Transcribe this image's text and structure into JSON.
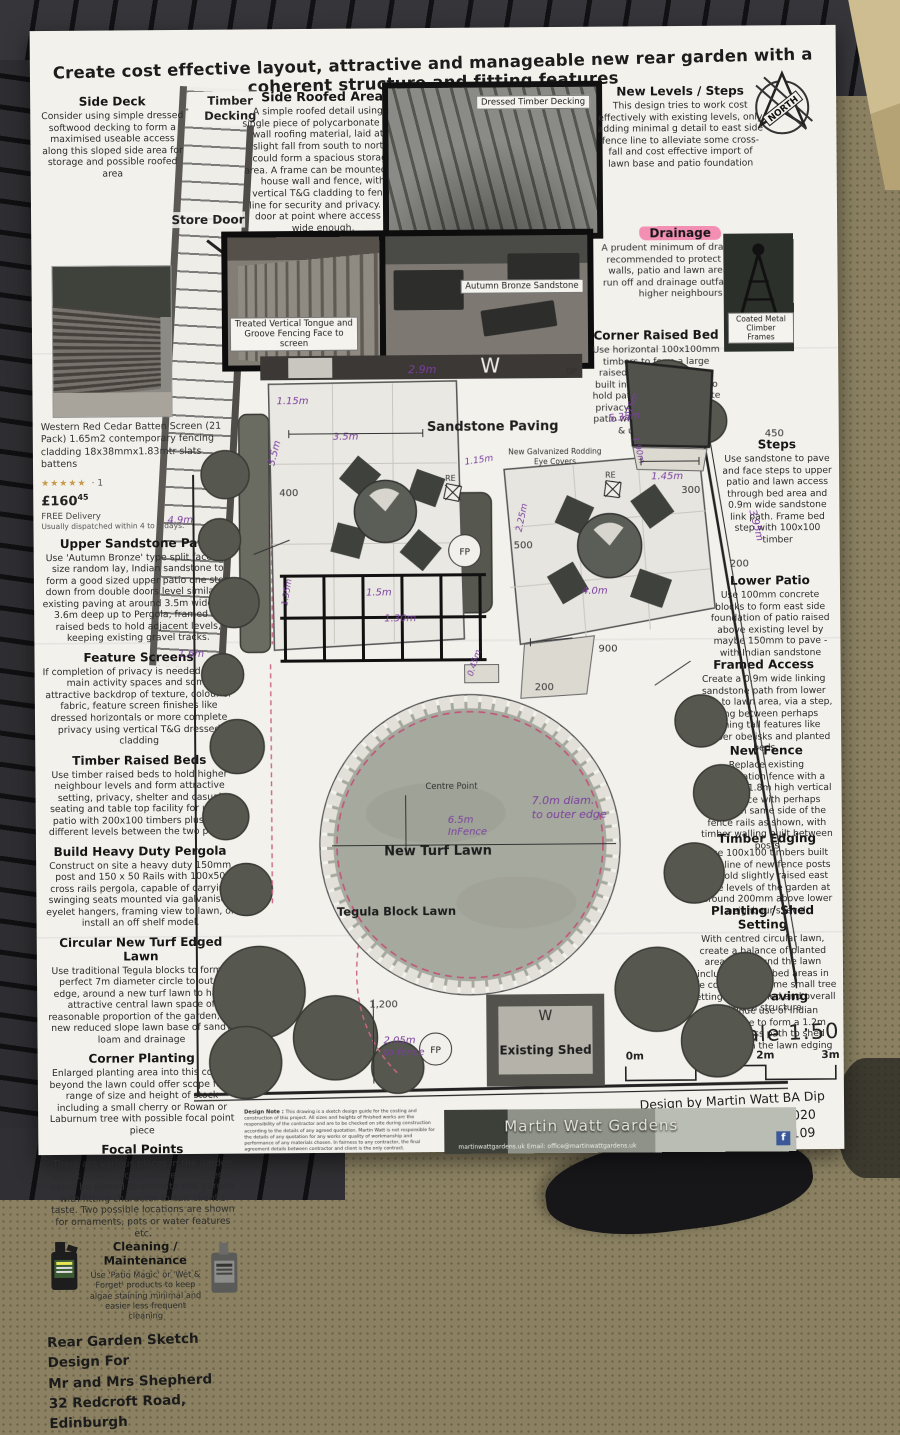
{
  "title": "Create cost effective layout, attractive and manageable new rear garden with a coherent structure and fitting features",
  "north_label": "NORTH",
  "left_column": {
    "side_deck_heading": "Side Deck",
    "side_deck_body": "Consider using simple dressed softwood decking to form a maximised useable access along this sloped side area for storage and possible roofed area",
    "timber_decking_label": "Timber Decking",
    "store_door_label": "Store Door",
    "product": {
      "caption": "Western Red Cedar Batten Screen (21 Pack) 1.65m2 contemporary fencing cladding 18x38mmx1.83mtr slats battens",
      "stars": "★★★★★",
      "rating": "· 1",
      "price_main": "£160",
      "price_sup": "45",
      "delivery": "FREE Delivery",
      "dispatch": "Usually dispatched within 4 to 5 days."
    },
    "sections": [
      {
        "heading": "Upper Sandstone Patio",
        "body": "Use 'Autumn Bronze' type split faced, 3 size random lay, Indian sandstone to form a good sized upper patio one step down from double doors level similar to existing paving at around 3.5m wide and 3.6m deep up to Pergola, framed by raised beds to hold adjacent levels, keeping existing gravel tracks."
      },
      {
        "heading": "Feature Screens",
        "body": "If completion of privacy is needed for the main activity spaces and some attractive backdrop of texture, colour or fabric, feature screen finishes like dressed horizontals or more complete privacy using vertical T&G dressed cladding"
      },
      {
        "heading": "Timber Raised Beds",
        "body": "Use timber raised beds to hold higher neighbour levels and form attractive setting, privacy, shelter and casual seating and table top facility for upper patio with 200x100 timbers plus hold different levels between the two patios"
      },
      {
        "heading": "Build Heavy Duty Pergola",
        "body": "Construct on site a heavy duty 150mm post and 150 x 50 Rails with 100x50 cross rails pergola, capable of carrying swinging seats mounted via galvanised eyelet hangers, framing view to lawn, or install an off shelf model."
      },
      {
        "heading": "Circular New Turf Edged Lawn",
        "body": "Use traditional Tegula blocks to form a perfect 7m diameter circle to outer edge, around a new turf lawn to have attractive central lawn space of reasonable proportion of the garden, on new reduced slope lawn base of sandy loam and drainage"
      },
      {
        "heading": "Corner Planting",
        "body": "Enlarged planting area into this corner beyond the lawn could offer scope for a range of size and height of stock including a small cherry or Rowan or Laburnum tree with possible focal point piece"
      },
      {
        "heading": "Focal Points",
        "body": "There are various places in the garden layout where focal point feature pieces could be placed to animate this garden with fitting character to suit client's taste.  Two possible locations are shown for ornaments, pots or water features etc."
      },
      {
        "heading": "Cleaning / Maintenance",
        "body": "Use 'Patio Magic' or 'Wet & Forget' products to keep algae staining minimal and easier less frequent cleaning"
      }
    ],
    "footer_lines": [
      "Rear Garden Sketch Design For",
      "Mr and Mrs Shepherd",
      "32 Redcroft Road, Edinburgh"
    ]
  },
  "top_center": {
    "heading": "Side Roofed Area",
    "body": "A simple roofed detail using a single piece of polycarbonate twin wall roofing material, laid at a slight fall from south to north, could form a spacious storage area. A frame can be mounted on house wall and fence, with vertical T&G cladding to fence line for security and privacy. Fix door at point where access is wide enough.",
    "photo_decking_caption": "Dressed Timber Decking",
    "photo_fence_caption": "Treated Vertical Tongue and Groove Fencing Face to screen",
    "photo_sandstone_caption": "Autumn Bronze Sandstone"
  },
  "right_column": {
    "new_levels_heading": "New Levels / Steps",
    "new_levels_body": "This design tries to work cost effectively with existing levels, only adding minimal g detail to east side fence line to alleviate some cross-fall and cost effective import of lawn base and patio foundation",
    "drainage_heading": "Drainage",
    "drainage_body": "A prudent minimum of drainage is recommended to protect timber walls, patio and lawn area from run off and drainage outfalls from higher neighbours",
    "corner_bed_heading": "Corner Raised Bed",
    "corner_bed_body": "Use horizontal 100x100mm timbers to form a large raised bed in this corner, built into new fence line to hold patio levels and  create privacy and setting for the patio with small cherry tree & under planting",
    "climber_caption": "Coated Metal Climber Frames",
    "steps_heading": "Steps",
    "steps_body": "Use sandstone to pave and face steps to upper patio and lawn access through bed area and 0.9m wide sandstone link path. Frame bed step with 100x100 timber",
    "lower_patio_heading": "Lower Patio",
    "lower_patio_body": "Use 100mm concrete blocks to form east side foundation of patio raised above existing level by maybe 150mm to pave - with Indian sandstone",
    "framed_access_heading": "Framed Access",
    "framed_access_body": "Create a 0.9m wide linking sandstone path from lower patio to lawn area, via a step, going between perhaps framing tall features like climber obelisks and planted beds",
    "new_fence_heading": "New Fence",
    "new_fence_body": "Replace existing demarcation fence with a matching 1.8m high vertical slat fence with perhaps posts on same side of the fence rails as shown, with timber walling built between posts",
    "timber_edging_heading": "Timber Edging",
    "timber_edging_body": "Use 100x100 timbers built into line of new fence posts to hold slightly raised east side levels of the garden at around 200mm above lower neighbour's level.",
    "planting_shed_heading": "Planting / Shed Setting",
    "planting_shed_body": "With centred circular lawn, create a balance of planted areas all around the lawn including larger bed areas in the corner with some small tree setting for the shed and overall garden structure",
    "shed_paving_heading": "Shed Paving",
    "shed_paving_body": "Continue use of Indian sandstone to form a 1.2m wide access path to shed linking from the lawn edging",
    "scale_title": "Scale 1:50",
    "scale_ticks": [
      "0m",
      "1m",
      "2m",
      "3m"
    ],
    "credit_lines": [
      "Design by Martin Watt BA Dip",
      "Copyright December 2020",
      "Telephone 01506 834 109"
    ]
  },
  "plan": {
    "labels": {
      "sandstone_paving": "Sandstone Paving",
      "rodding_l1": "New Galvanized Rodding",
      "rodding_l2": "Eye Covers",
      "re": "RE",
      "centre_point": "Centre Point",
      "diam_l1": "7.0m diam.",
      "diam_l2": "to outer edge",
      "infence_l1": "6.5m",
      "infence_l2": "InFence",
      "new_turf_lawn": "New Turf Lawn",
      "tegula": "Tegula Block Lawn",
      "existing_shed": "Existing Shed",
      "window": "W",
      "fp": "FP",
      "dp": "DP"
    },
    "dims": {
      "d_115a": "1.15m",
      "d_35a": "3.5m",
      "d_35b": "3.5m",
      "d_400": "400",
      "d_29": "2.9m",
      "d_535": "5.35m",
      "d_190": "1.90m",
      "d_49": "4.9m",
      "d_16": "1.6m",
      "d_15": "1.5m",
      "d_130": "1.30m",
      "d_135": "1.35m",
      "d_045": "0.45m",
      "d_200": "200",
      "d_500": "500",
      "d_225": "2.25m",
      "d_900": "900",
      "d_40": "4.0m",
      "d_395": "3.95m",
      "d_115b": "1.15m",
      "d_145": "1.45m",
      "d_300": "300",
      "d_450": "450",
      "d_1200": "1,200",
      "d_205a": "2.05m",
      "d_205b": "to fence"
    }
  },
  "footer_note": {
    "design_note_label": "Design Note : ",
    "design_note": "This drawing is a sketch design guide for the costing and construction of this project. All sizes and heights of finished works are the responsibility of the contractor and are to be checked on site during construction according to the details of any agreed quotation. Martin Watt is not responsible for the details of any quotation for any works or quality of workmanship and performance of any materials chosen. In fairness to any contractor, the final agreement details between contractor and client is the only contract.",
    "banner_title": "Martin Watt Gardens",
    "banner_contact": "martinwattgardens.uk   Email: office@martinwattgardens.uk",
    "facebook_f": "f"
  },
  "colors": {
    "accent_purple": "#7b3fa0",
    "highlight_pink": "#f48fb4",
    "lawn_edge_pink": "#c2557a"
  }
}
